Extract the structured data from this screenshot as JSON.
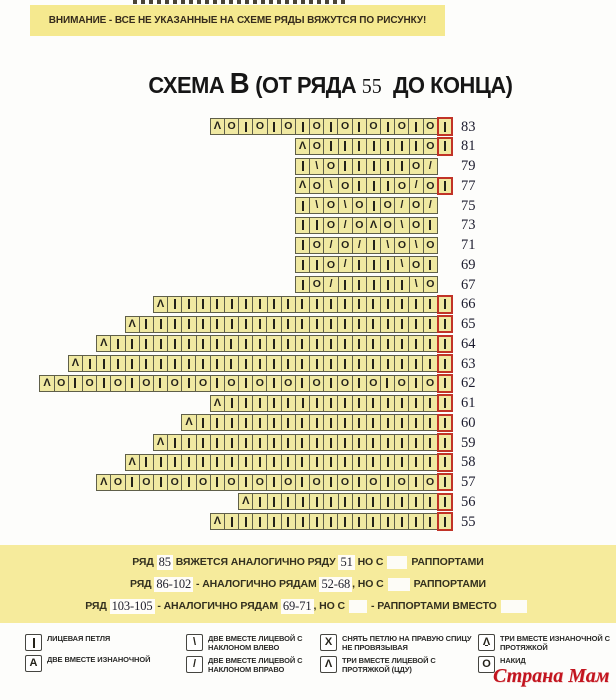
{
  "banner": {
    "attention": "ВНИМАНИЕ - ВСЕ НЕ УКАЗАННЫЕ НА СХЕМЕ РЯДЫ ВЯЖУТСЯ ПО РИСУНКУ!"
  },
  "title": {
    "word": "СХЕМА ",
    "letter": "В",
    "open": " (ОТ РЯДА ",
    "row_from": "55",
    "close": "  ДО КОНЦА)"
  },
  "chart_data": {
    "type": "knitting-chart",
    "title": "СХЕМА В (ОТ РЯДА 55 ДО КОНЦА)",
    "row_numbers_side": "right",
    "rows_top_to_bottom": [
      {
        "num": "83",
        "cells": "^O|O|O|O|O|O|O|O",
        "red_cell": true
      },
      {
        "num": "81",
        "cells": "^O|||||||O",
        "red_cell": true
      },
      {
        "num": "79",
        "cells": "|\\O|||||O/",
        "red_cell": false
      },
      {
        "num": "77",
        "cells": "^O\\O|||O/O",
        "red_cell": true
      },
      {
        "num": "75",
        "cells": "|\\O\\O|O/O/",
        "red_cell": false
      },
      {
        "num": "73",
        "cells": "||O/O^O\\O|",
        "red_cell": false
      },
      {
        "num": "71",
        "cells": "|O/O/|\\O\\O",
        "red_cell": false
      },
      {
        "num": "69",
        "cells": "||O/|||\\O|",
        "red_cell": false
      },
      {
        "num": "67",
        "cells": "|O/|||||\\O",
        "red_cell": false
      },
      {
        "num": "66",
        "cells": "^|||||||||||||||||||",
        "red_cell": true
      },
      {
        "num": "65",
        "cells": "^|||||||||||||||||||||",
        "red_cell": true
      },
      {
        "num": "64",
        "cells": "^|||||||||||||||||||||||",
        "red_cell": true
      },
      {
        "num": "63",
        "cells": "^|||||||||||||||||||||||||",
        "red_cell": true
      },
      {
        "num": "62",
        "cells": "^O|O|O|O|O|O|O|O|O|O|O|O|O|O",
        "red_cell": true
      },
      {
        "num": "61",
        "cells": "^|||||||||||||||",
        "red_cell": true
      },
      {
        "num": "60",
        "cells": "^|||||||||||||||||",
        "red_cell": true
      },
      {
        "num": "59",
        "cells": "^|||||||||||||||||||",
        "red_cell": true
      },
      {
        "num": "58",
        "cells": "^|||||||||||||||||||||",
        "red_cell": true
      },
      {
        "num": "57",
        "cells": "^O|O|O|O|O|O|O|O|O|O|O|O",
        "red_cell": true
      },
      {
        "num": "56",
        "cells": "^|||||||||||||",
        "red_cell": true
      },
      {
        "num": "55",
        "cells": "^|||||||||||||||",
        "red_cell": true
      }
    ],
    "red_cell_symbol": "|",
    "colors": {
      "cell_fill": "#f0e9a2",
      "cell_border": "#5f5f49",
      "red_highlight": "#c13327",
      "banner_bg": "#f5e98f",
      "notes_bg": "#f6eb9c"
    }
  },
  "notes": {
    "lines": [
      [
        {
          "text": "РЯД "
        },
        {
          "text": "85",
          "style": "num"
        },
        {
          "text": " ВЯЖЕТСЯ АНАЛОГИЧНО РЯДУ "
        },
        {
          "text": "51",
          "style": "num"
        },
        {
          "text": " НО С"
        },
        {
          "style": "gap",
          "w": 20
        },
        {
          "text": "РАППОРТАМИ"
        }
      ],
      [
        {
          "text": "РЯД "
        },
        {
          "text": "86-102",
          "style": "num"
        },
        {
          "text": " - АНАЛОГИЧНО РЯДАМ "
        },
        {
          "text": "52-68",
          "style": "num"
        },
        {
          "text": ", НО С"
        },
        {
          "style": "gap",
          "w": 22
        },
        {
          "text": "РАППОРТАМИ"
        }
      ],
      [
        {
          "text": "РЯД "
        },
        {
          "text": "103-105",
          "style": "num"
        },
        {
          "text": " - АНАЛОГИЧНО РЯДАМ "
        },
        {
          "text": "69-71",
          "style": "num"
        },
        {
          "text": ", НО С"
        },
        {
          "style": "gap",
          "w": 18
        },
        {
          "text": "- РАППОРТАМИ ВМЕСТО"
        },
        {
          "style": "gap",
          "w": 26
        }
      ]
    ]
  },
  "legend": {
    "columns": [
      [
        {
          "sym": "|",
          "icon": "knit-stitch-icon",
          "label": "ЛИЦЕВАЯ ПЕТЛЯ"
        },
        {
          "sym": "A",
          "icon": "p2tog-icon",
          "label": "ДВЕ ВМЕСТЕ ИЗНАНОЧНОЙ"
        }
      ],
      [
        {
          "sym": "\\",
          "icon": "k2tog-left-icon",
          "label": "ДВЕ ВМЕСТЕ ЛИЦЕВОЙ С НАКЛОНОМ ВЛЕВО"
        },
        {
          "sym": "/",
          "icon": "k2tog-right-icon",
          "label": "ДВЕ ВМЕСТЕ ЛИЦЕВОЙ С НАКЛОНОМ ВПРАВО"
        }
      ],
      [
        {
          "sym": "X",
          "icon": "slip-stitch-icon",
          "label": "СНЯТЬ ПЕТЛЮ НА ПРАВУЮ СПИЦУ НЕ ПРОВЯЗЫВАЯ"
        },
        {
          "sym": "^",
          "icon": "k3tog-cdd-icon",
          "label": "ТРИ ВМЕСТЕ ЛИЦЕВОЙ С ПРОТЯЖКОЙ (ЦДУ)"
        }
      ],
      [
        {
          "sym": "^p",
          "icon": "p3tog-icon",
          "label": "ТРИ ВМЕСТЕ ИЗНАНОЧНОЙ С ПРОТЯЖКОЙ"
        },
        {
          "sym": "O",
          "icon": "yarn-over-icon",
          "label": "НАКИД"
        }
      ]
    ]
  },
  "watermark": "Страна Мам"
}
